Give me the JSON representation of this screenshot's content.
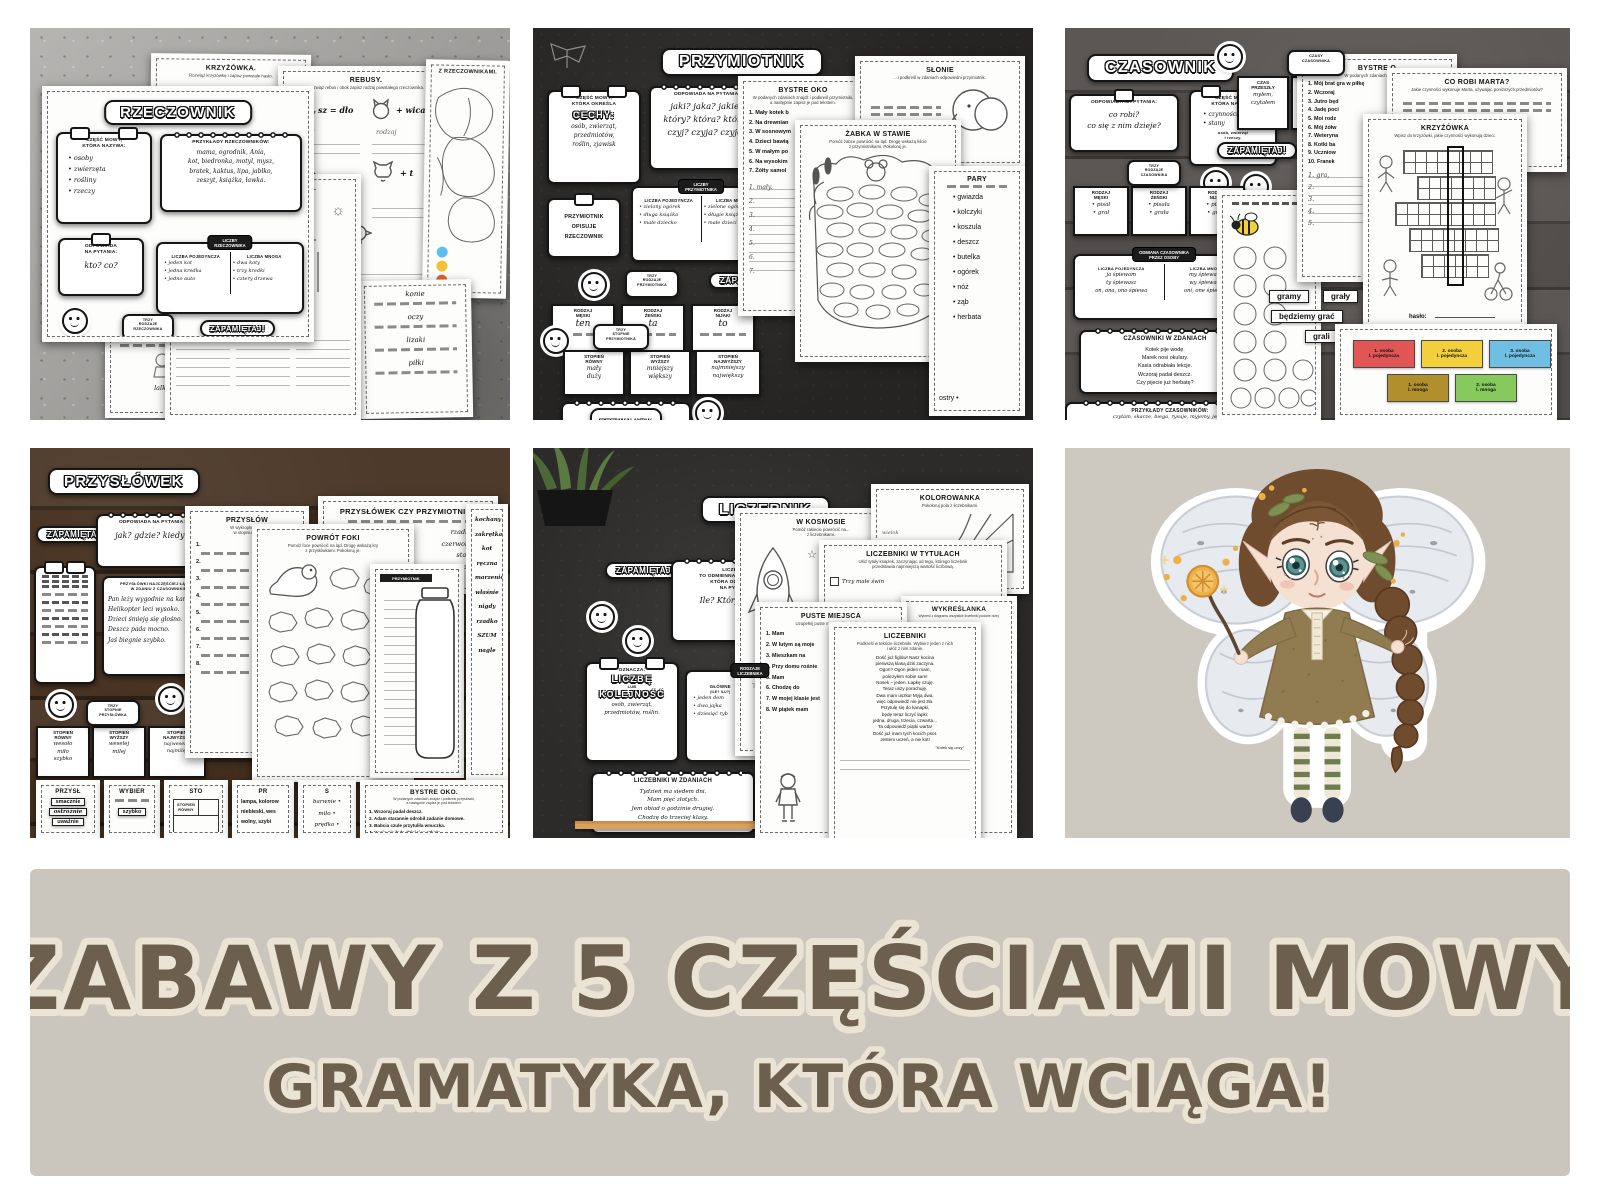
{
  "banner": {
    "line1": "ZABAWY Z 5 CZĘŚCIAMI MOWY",
    "line2": "GRAMATYKA, KTÓRA WCIĄGA!"
  },
  "icons": {
    "star": "☆",
    "sun": "☼"
  },
  "p1": {
    "title": "RZECZOWNIK",
    "card_czesc": {
      "t": "CZĘŚĆ MOWY,\nKTÓRA NAZYWA:",
      "items": "• osoby\n• zwierzęta\n• rośliny\n• rzeczy"
    },
    "card_prz": {
      "t": "PRZYKŁADY RZECZOWNIKÓW:",
      "words": "mama, ogrodnik, Ania,\nkot, biedronka, motyl, mysz,\nbratek, kaktus, lipa, jabłko,\nzeszyt, książka, ławka."
    },
    "card_odp": {
      "t": "ODPOWIADA\nNA PYTANIA:",
      "q": "kto? co?"
    },
    "card_liczby": {
      "band": "LICZBY\nRZECZOWNIKA",
      "c1t": "LICZBA POJEDYNCZA",
      "c1": "• jeden kot\n• jedna kredka\n• jedno auto",
      "c2t": "LICZBA MNOGA",
      "c2": "• dwa koty\n• trzy kredki\n• cztery drzewa"
    },
    "zap": "ZAPAMIĘTAJ!",
    "band_rodzaje": "TRZY\nRODZAJE\nRZECZOWNIKA",
    "r1": {
      "t": "RODZAJ\nMĘSKI",
      "w": "ten"
    },
    "r2": {
      "t": "RODZAJ\nŻEŃSKI",
      "w": "ta"
    },
    "r3": {
      "t": "RODZAJ\nNIJAKI",
      "w": "to"
    },
    "ws_k": {
      "t": "KRZYŻÓWKA.",
      "sub": "Rozwiąż krzyżówkę i zapisz powstałe hasło.",
      "n1": "1.",
      "n5": "5."
    },
    "ws_r": {
      "t": "REBUSY.",
      "sub": "Rozwiąż rebus i obok zapisz rodzaj powstałego rzeczownika.",
      "r1": "sz = dło",
      "r2": "+ wica",
      "r3": "+ t",
      "r4": "m +",
      "hw": "rodzaj"
    },
    "ws_c": {
      "t": "Z RZECZOWNIKAMI."
    },
    "ws_o": {
      "t": "OBRAZKOWE RZECZOWNIKI.",
      "sub": "Odszukaj na obrazku 12 rzeczowników."
    },
    "ws_w": {
      "w1": "konie",
      "w2": "oczy",
      "w3": "lizaki",
      "w4": "piłki"
    },
    "ws_f": {
      "c1": "lalka",
      "c2": "Marek"
    }
  },
  "p2": {
    "title": "PRZYMIOTNIK",
    "card_cechy": {
      "t": "CZĘŚĆ MOWY,\nKTÓRA OKREŚLA",
      "big": "CECHY:",
      "items": "osób, zwierząt,\nprzedmiotów,\nroślin, zjawisk"
    },
    "card_odp": {
      "t": "ODPOWIADA NA PYTANIA:",
      "q": "jaki? jaka? jakie?\nktóry? która? które?\nczyj? czyja? czyje?"
    },
    "card_opisuje": "PRZYMIOTNIK\nOPISUJE\nRZECZOWNIK",
    "card_liczby": {
      "band": "LICZBY\nPRZYMIOTNIKA",
      "c1t": "LICZBA POJEDYNCZA",
      "c1": "• zielony ogórek\n• długa książka\n• małe dziecko",
      "c2t": "LICZBA MNOGA",
      "c2": "• zielone ogórki\n• długie książki\n• małe dzieci"
    },
    "zap": "ZAPAMIĘTAJ!",
    "band_rodzaje": "TRZY\nRODZAJE\nPRZYMIOTNIKA",
    "r1": {
      "t": "RODZAJ\nMĘSKI",
      "w": "ten"
    },
    "r2": {
      "t": "RODZAJ\nŻEŃSKI",
      "w": "ta"
    },
    "r3": {
      "t": "RODZAJ\nNIJAKI",
      "w": "to"
    },
    "band_stopnie": "TRZY\nSTOPNIE\nPRZYMIOTNIKA",
    "s1": {
      "t": "STOPIEŃ\nRÓWNY",
      "w": "mały\nduży"
    },
    "s2": {
      "t": "STOPIEŃ\nWYŻSZY",
      "w": "mniejszy\nwiększy"
    },
    "s3": {
      "t": "STOPIEŃ\nNAJWYŻSZY",
      "w": "najmniejszy\nnajwiększy"
    },
    "card_przyklady": {
      "t": "PRZYKŁADY",
      "c1": "• mały kotek\n• miła pani\n• młode ptaki\n• ulubiony deserek\n• długa ulica\n• pyszniutkie jajko",
      "c2": "• zielona bluzka\n• duże lampy\n• głośne dzieci\n• czerwona maska\n• pusta butelka\n• krakowska ulica"
    },
    "ws_b": {
      "t": "BYSTRE OKO",
      "sub": "W podanych zdaniach znajdź i podkreśl przymiotniki,\na następnie zapisz je pod tekstem.",
      "items": "1. Mały kotek b\n2. Na drewnian\n3. W sosnowym\n4. Dzieci bawią\n5. W małym po\n6. Na wysokim\n7. Żółty samol",
      "ans": "1. mały.\n2.\n3.\n4.\n5.\n6.\n7."
    },
    "ws_z": {
      "t": "ŻABKA W STAWIE",
      "sub": "Pomóż żabce powrócić na ląd. Drogę wskażą liście\nz przymiotnikami. Pokoloruj je."
    },
    "ws_s": {
      "t": "SŁONIE",
      "sub": "...i podkreśl w zdaniach odpowiedni przymiotnik."
    },
    "ws_p": {
      "t": "PARY",
      "left": "ostry •",
      "list": "• gwiazda\n• kolczyki\n• koszula\n• deszcz\n• butelka\n• ogórek\n• nóż\n• ząb\n• herbata"
    }
  },
  "p3": {
    "title": "CZASOWNIK",
    "card_odp": {
      "t": "ODPOWIADA NA PYTANIA:",
      "q": "co robi?\nco się z nim dzieje?"
    },
    "card_czesc": {
      "t": "CZĘŚĆ MOWY,\nKTÓRA NAZYWA:",
      "items": "• czynności\n• stany",
      "sub": "osób, zwierząt\ni rzeczy."
    },
    "card_czasy": {
      "band": "CZASY\nCZASOWNIKA",
      "c1t": "CZAS\nPRZESZŁY",
      "c1": "myłem,\nczytałem",
      "c2t": "CZAS\nTERAŹNIEJSZY",
      "c2": "myję,\nczytam",
      "c3t": "CZAS\nPRZYSZŁY",
      "c3": "będę mył,\nbędę czytał"
    },
    "zap": "ZAPAMIĘTAJ!",
    "band_rodzaje": "TRZY\nRODZAJE\nCZASOWNIKA",
    "r1": {
      "t": "RODZAJ\nMĘSKI",
      "w": "• pisał\n• grał"
    },
    "r2": {
      "t": "RODZAJ\nŻEŃSKI",
      "w": "• pisała\n• grała"
    },
    "r3": {
      "t": "RODZAJ\nNIJAKI",
      "w": "• pisało\n• grało"
    },
    "card_odmiana": {
      "band": "ODMIANA CZASOWNIKA\nPRZEZ OSOBY",
      "c1t": "LICZBA POJEDYNCZA",
      "c1": "ja śpiewam\nty śpiewasz\non, ona, ono śpiewa",
      "c2t": "LICZBA MNOGA",
      "c2": "my śpiewamy\nwy śpiewacie\noni, one śpiewają"
    },
    "card_zdania": {
      "t": "CZASOWNIKI W ZDANIACH",
      "text": "Kotek pije wodę.\nMarek nosi okulary.\nKasia odrabiała lekcje.\nWczoraj padał deszcz.\nCzy pijecie już herbatę?"
    },
    "card_przyklady": {
      "t": "PRZYKŁADY CZASOWNIKÓW:",
      "text": "czytam, skacze, biega, rysuje, myjemy, jedzą,\nkąpiesz, lubisz, kupiła, zbiera, uśmiał się, mówi,\nskacze, przygotowujemy, tańczę, rzuca, gotuje,\nidzie, śpiewały, przesuwamy, podskakuje, gram."
    },
    "ws_b": {
      "t": "BYSTRE O",
      "sub": "W podanych zdaniach znajdź i p...",
      "items": "1. Mój brat gra w piłkę\n2. Wczoraj\n3. Jutro będ\n4. Jadę poci\n5. Moi rodz\n6. Mój żółw\n7. Weteryna\n8. Kotki ba\n9. Uczniow\n10. Franek",
      "ans": "1. gra,\n2.\n3.\n4.\n5."
    },
    "ws_m": {
      "t": "CO ROBI MARTA?",
      "sub": "Jakie czynności wykonuje Marta, używając poniższych przedmiotów?"
    },
    "ws_k": {
      "t": "KRZYŻÓWKA",
      "sub": "Wpisz do krzyżówki, jakie czynności wykonują dzieci.",
      "haslo": "hasło:"
    },
    "pills": {
      "p1": "gramy",
      "p2": "grały",
      "p3": "będziemy grać",
      "p4": "grali"
    },
    "osoby": {
      "b1": "1. osoba\nl. pojedyncza",
      "b2": "2. osoba\nl. pojedyncza",
      "b3": "3. osoba\nl. pojedyncza",
      "b4": "1. osoba\nl. mnoga",
      "b5": "2. osoba\nl. mnoga"
    }
  },
  "p4": {
    "title": "PRZYSŁÓWEK",
    "zap": "ZAPAMIĘTAJ!",
    "card_odp": {
      "t": "ODPOWIADA NA PYTANIA:",
      "q": "jak? gdzie? kiedy?"
    },
    "card_laczy": {
      "t": "PRZYSŁÓWKI NAJCZĘŚCIEJ ŁĄCZĄ SIĘ\nW ZDANIU Z CZASOWNIKIEM.",
      "text": "Pan leży wygodnie na kanapie.\nHelikopter leci wysoko.\nDzieci śmieją się głośno.\nDeszcz pada mocno.\nJaś biegnie szybko."
    },
    "band_stopnie": "TRZY\nSTOPNIE\nPRZYSŁÓWKA",
    "s1": {
      "t": "STOPIEŃ\nRÓWNY",
      "w": "wesoło\nmiło\nszybko"
    },
    "s2": {
      "t": "STOPIEŃ\nWYŻSZY",
      "w": "weselej\nmilej"
    },
    "s3": {
      "t": "STOPIEŃ\nNAJWYŻSZY",
      "w": "najweselej\nnajmilej"
    },
    "ws_zd": {
      "t": "PRZYSŁÓW",
      "sub": "W wykropkowane\nw stopniu wyż"
    },
    "ws_f": {
      "t": "POWRÓT FOKI",
      "sub": "Pomóż foce powrócić na ląd. Drogę wskażą kry\nz przysłówkami. Pokoloruj je."
    },
    "ws_c": {
      "t": "PRZYSŁÓWEK CZY PRZYMIOTNIK?",
      "pairs": "rzadko\nczerwona\nstary\nwrogi"
    },
    "jar_label": "PRZYMIOTNIK",
    "strip_words": "kochany\nzakrętka\nkot\nręczna\nmarzenie\nwłaśnie\nnigdy\nrzadko\nSZUM\nnagle",
    "bottom": {
      "c1t": "PRZYSŁ",
      "c1w1": "smacznie",
      "c1w2": "ostrożnie",
      "c1w3": "uważnie",
      "c2t": "WYBIER",
      "c2w1": "szybko",
      "c3t": "STO",
      "c3h": "STOPIEŃ\nRÓWNY",
      "c4t": "PR",
      "c4text": "lampa, kolorow\nniebieski, wes\nwolny, szybi",
      "c5t": "S",
      "c5text": "barwnie •\nmiło •\nprędko •",
      "c6t": "BYSTRE OKO.",
      "c6sub": "W podanych zdaniach znajdź i podkreśl przysłówki,\na następnie zapisz je pod tekstem.",
      "c6items": "1. Wczoraj padał deszcz.\n2. Adam starannie odrobił zadanie domowe.\n3. Babcia czule przytuliła wnuczka.\n4. Kasia nie była dzisiaj w szkole."
    }
  },
  "p5": {
    "title": "LICZEBNIK",
    "zap": "ZAPAMIĘTAJ!",
    "card_def": {
      "t": "LICZEBNIK\nTO ODMIENNA CZĘŚĆ MOWY,\nKTÓRA ODPOWIADA\nNA PYTANIA:",
      "q": "Ile? Który z kolei?"
    },
    "card_ozn": {
      "t": "OZNACZA:",
      "b1": "LICZBĘ",
      "mid": "LUB",
      "b2": "KOLEJNOŚĆ",
      "sub": "osób, zwierząt,\nprzedmiotów, roślin."
    },
    "card_rodz": {
      "band": "RODZAJE\nLICZEBNIKA",
      "c1t": "GŁÓWNE",
      "c1q": "(ILE? ILU?)",
      "c1": "• jeden dom\n• dwa jajka\n• dziesięć ryb",
      "c2t": "PORZĄDKOWE",
      "c2q": "(KTÓRY Z KOLEI?)",
      "c2": "• pierwsza klasa\n• trzeci rok\n• piąta godzina"
    },
    "card_zdania": {
      "t": "LICZEBNIKI W ZDANIACH",
      "text": "Tydzień ma siedem dni.\nMam pięć złotych.\nJem obiad o godzinie drugiej.\nChodzę do trzeciej klasy."
    },
    "ws_kos": {
      "t": "W KOSMOSIE",
      "sub": "Pomóż rakiecie powrócić na...\nz liczebnikami."
    },
    "ws_kol": {
      "t": "KOLOROWANKA",
      "sub": "Pokoloruj pola z liczebnikami."
    },
    "ws_tyt": {
      "t": "LICZEBNIKI W TYTUŁACH",
      "sub": "Ułóż tytuły książek, zaczynając od tego, którego liczebnik\nprzedstawia najmniejszą wartość liczbową.",
      "item": "Trzy małe świn"
    },
    "ws_pus": {
      "t": "PUSTE MIEJSCA",
      "sub": "Uzupełnij puste miejsca liczebnikami.",
      "items": "1. Mam\n2. W lutym są moje\n3. Mieszkam na\n4. Przy domu rośnie\n5. Mam\n6. Chodzę do\n7. W mojej klasie jest\n8. W piątek mam"
    },
    "ws_licz": {
      "t": "LICZEBNIKI",
      "sub": "Podkreśl w tekście liczebniki. Wybierz jeden z nich\ni ułóż z nim zdanie.",
      "poem": "Dość już figlów! Nasz kocina\npierwszą klasą dziś zaczyna.\nOgon? Ogon jeden mam,\npoliczyłem sobie sam!\nNosek – jeden. Łapkę czuję.\nTeraz uszy porachuję.\nDwa mam uszka! Myją dwa,\nwięc odpowiedź nie jest zła.\nPrzytulę się do kanapki,\nbędę teraz liczyć łapki:\njedna, druga, trzecia, czwarta...\nTa odpowiedź piątki warta!\nDość już mam tych kocich psot.\nJestem uczeń, a nie kot!",
      "credit": "\"Kotek się uczy\""
    },
    "ws_wyk": {
      "t": "WYKREŚLANKA",
      "sub": "Wykreśl z diagramu wszystkie liczebniki podane niżej.",
      "grid": "I Ę Ć\nE M T\nB Z Y\nI J S\nL E I\nI D Ą\nO E C\nN N I\nE Ś Ć\nI Ę Ć",
      "words": "siedem, osiem,\npiętnaście, sto,"
    }
  }
}
